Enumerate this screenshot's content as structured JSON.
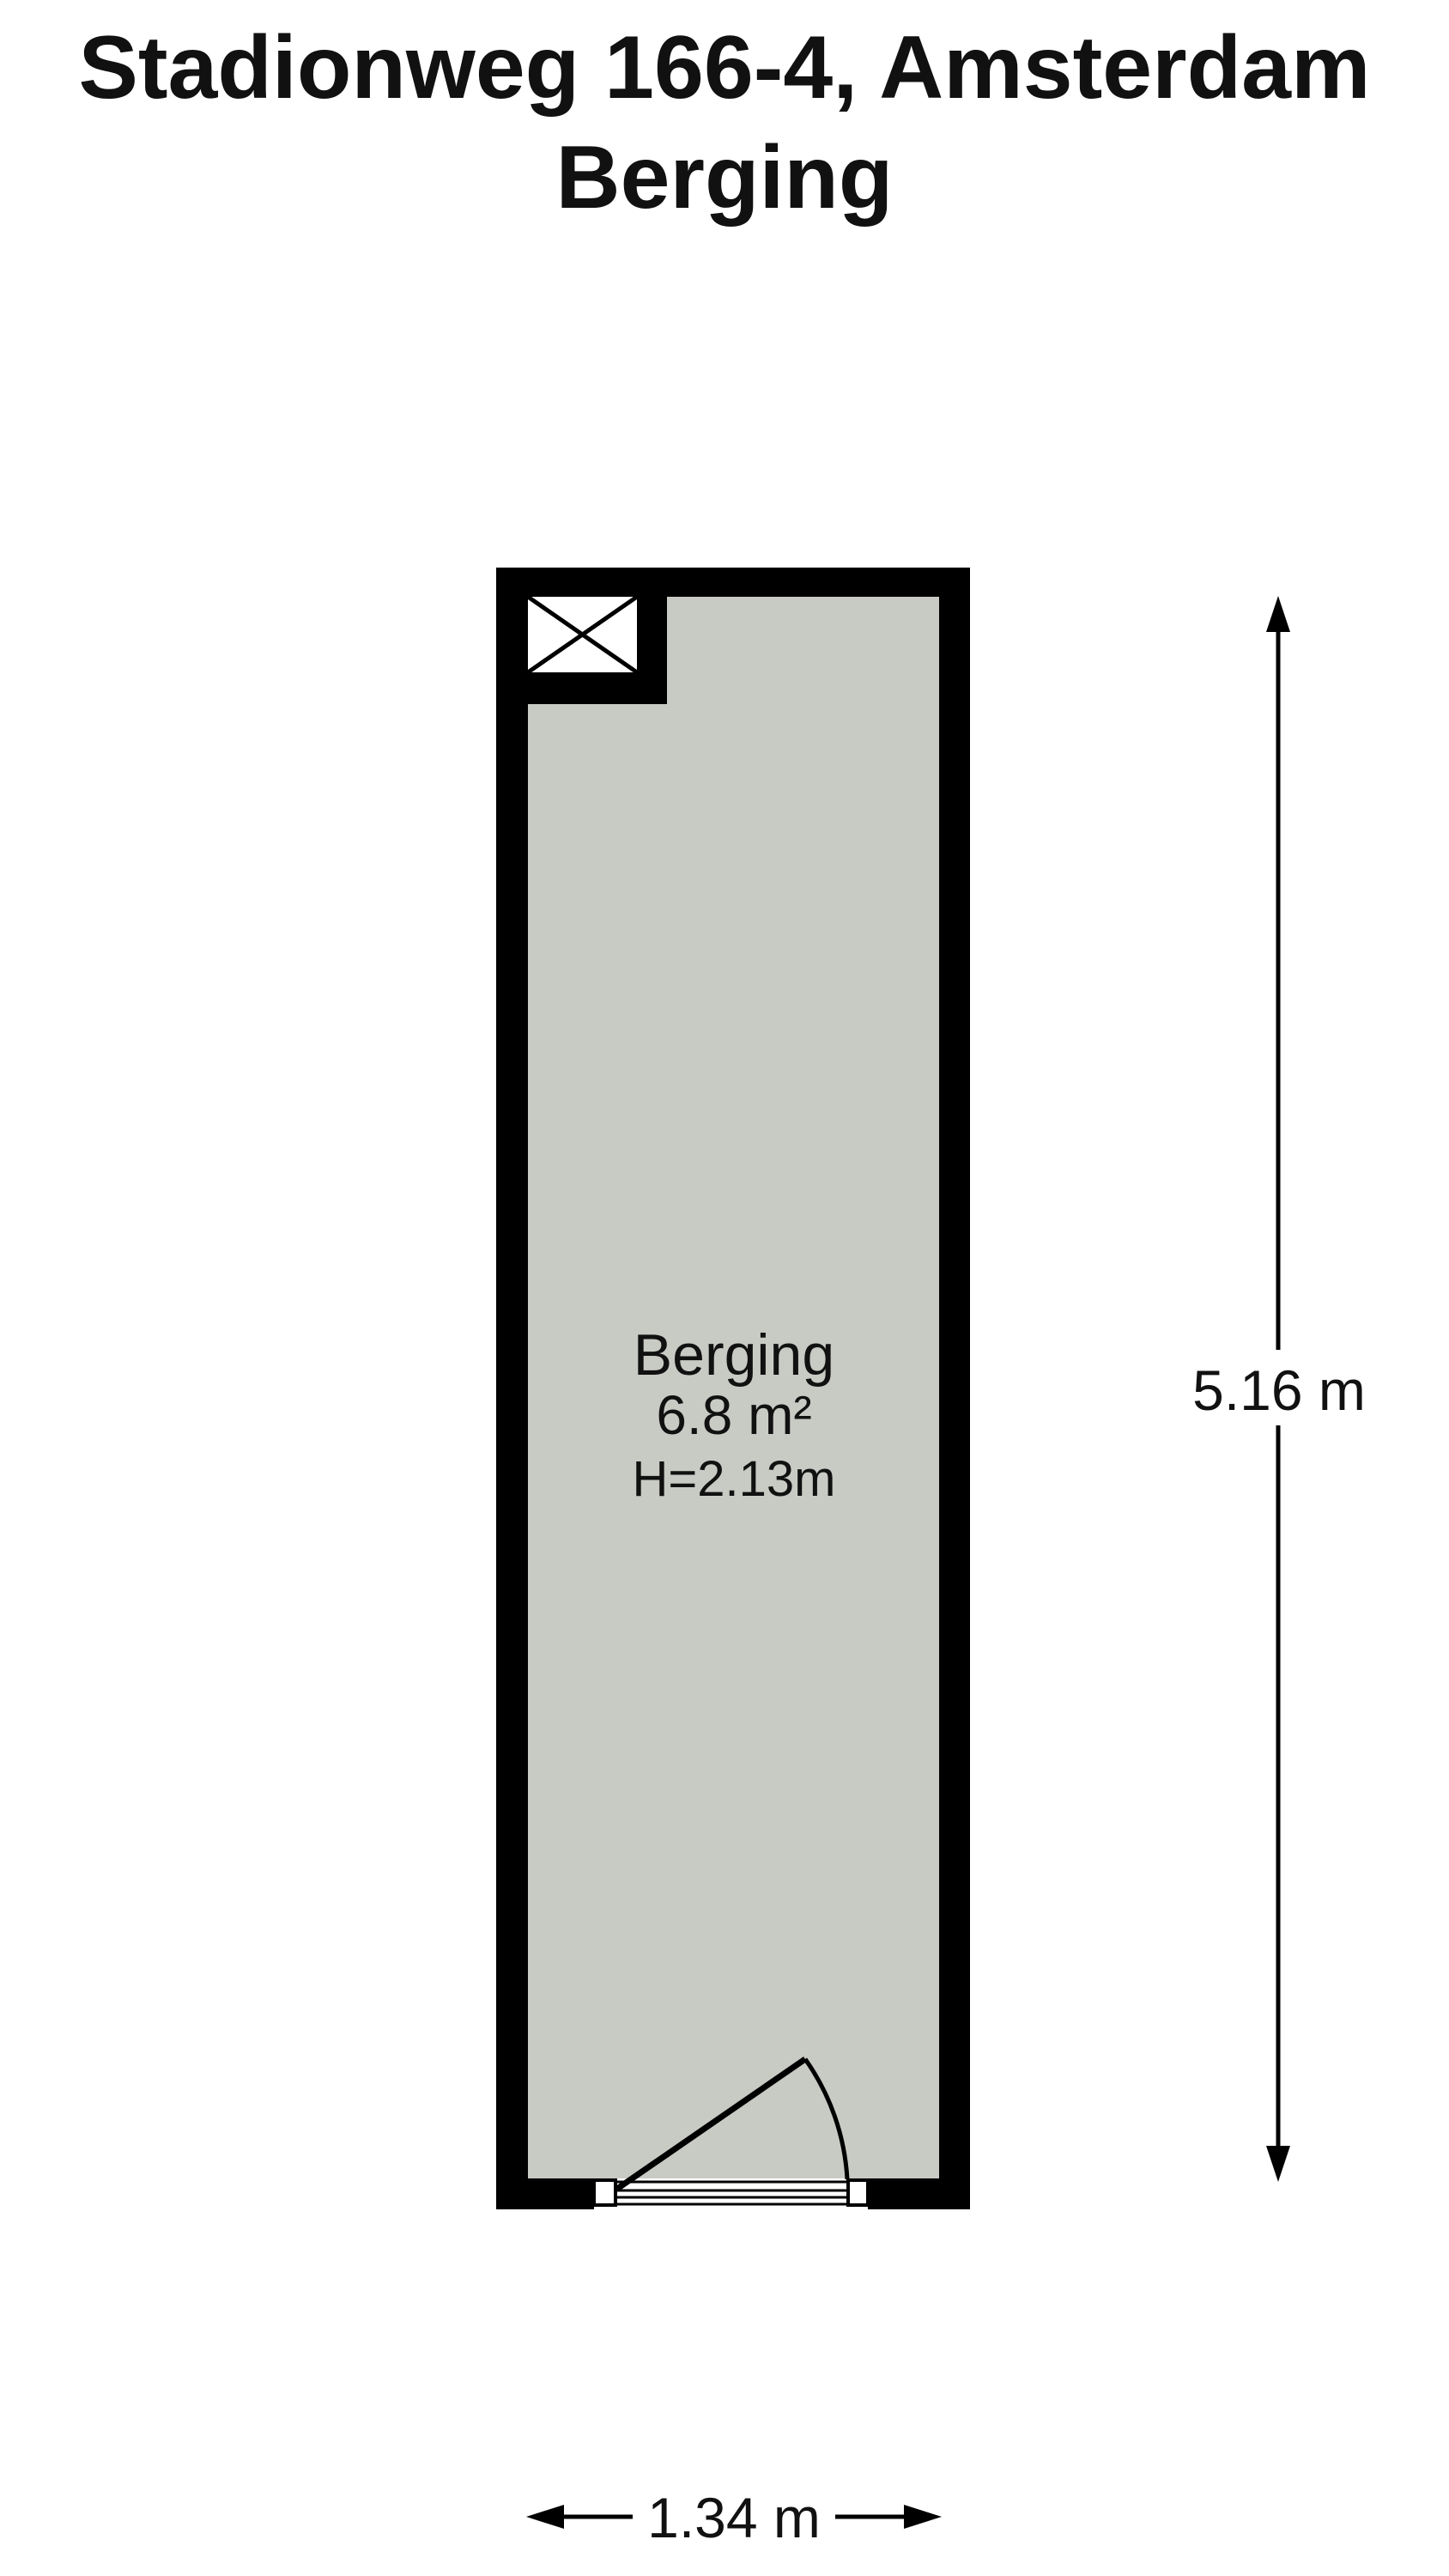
{
  "title": {
    "line1": "Stadionweg 166-4, Amsterdam",
    "line2": "Berging"
  },
  "room": {
    "name": "Berging",
    "area": "6.8 m²",
    "ceiling_height": "H=2.13m"
  },
  "dimensions": {
    "height_label": "5.16 m",
    "width_label": "1.34 m"
  },
  "colors": {
    "wall": "#000000",
    "floor": "#c8cbc4",
    "background": "#ffffff"
  }
}
